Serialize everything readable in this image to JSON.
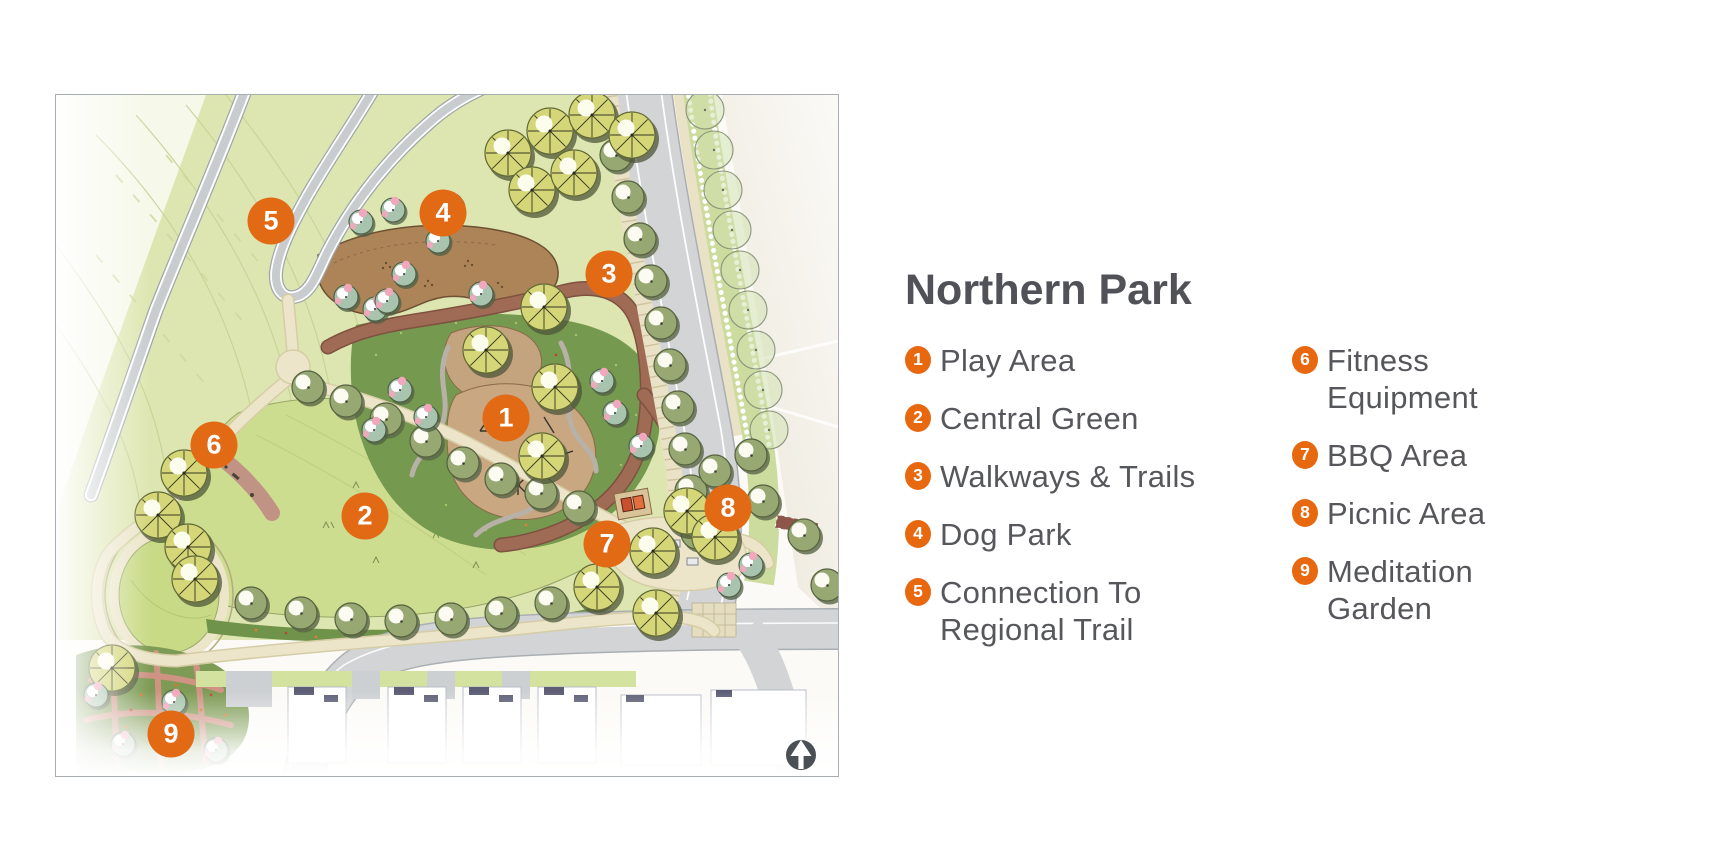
{
  "legend": {
    "title": "Northern Park",
    "accent_color": "#e8680f",
    "text_color": "#56575b",
    "items": [
      {
        "number": "1",
        "label": "Play Area"
      },
      {
        "number": "2",
        "label": "Central Green"
      },
      {
        "number": "3",
        "label": "Walkways & Trails"
      },
      {
        "number": "4",
        "label": "Dog Park"
      },
      {
        "number": "5",
        "label": "Connection To\nRegional Trail"
      },
      {
        "number": "6",
        "label": "Fitness Equipment"
      },
      {
        "number": "7",
        "label": "BBQ Area"
      },
      {
        "number": "8",
        "label": "Picnic Area"
      },
      {
        "number": "9",
        "label": "Meditation Garden"
      }
    ]
  },
  "map": {
    "marker_color": "#e26a15",
    "markers": [
      {
        "number": "1",
        "x": 450,
        "y": 323
      },
      {
        "number": "2",
        "x": 309,
        "y": 421
      },
      {
        "number": "3",
        "x": 553,
        "y": 179
      },
      {
        "number": "4",
        "x": 387,
        "y": 118
      },
      {
        "number": "5",
        "x": 215,
        "y": 126
      },
      {
        "number": "6",
        "x": 158,
        "y": 350
      },
      {
        "number": "7",
        "x": 551,
        "y": 449
      },
      {
        "number": "8",
        "x": 672,
        "y": 413
      },
      {
        "number": "9",
        "x": 115,
        "y": 639
      }
    ]
  }
}
